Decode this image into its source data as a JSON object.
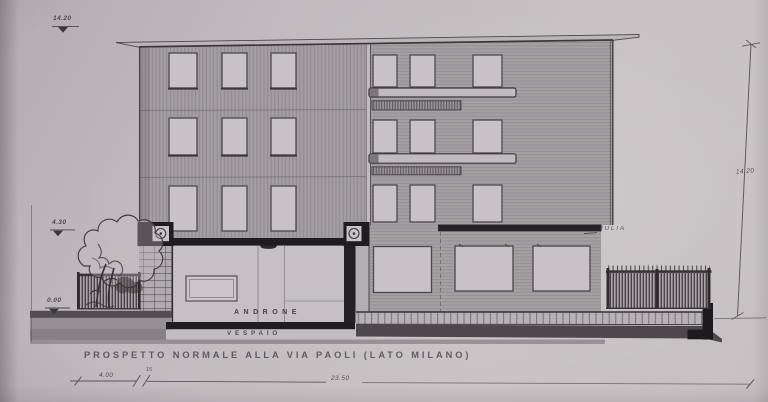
{
  "drawing": {
    "title": "PROSPETTO NORMALE ALLA VIA PAOLI (LATO MILANO)",
    "labels": {
      "androne": "ANDRONE",
      "vespaio": "VESPAIO",
      "volta": "VOLTA"
    },
    "level_markers": [
      {
        "value": "14.20",
        "description": "roof level marker, top left"
      },
      {
        "value": "4.30",
        "description": "first floor slab level marker"
      },
      {
        "value": "0.00",
        "description": "street level marker"
      }
    ],
    "dimensions": {
      "total_height": "14.20",
      "left_offset": "4.00",
      "wall_thickness": "15",
      "facade_length": "23.50"
    },
    "colors": {
      "paper": "#c2bec1",
      "ink": "#3c383b",
      "wall_tone": "#a39fa2",
      "cut_poche": "#1d1b1d"
    }
  }
}
